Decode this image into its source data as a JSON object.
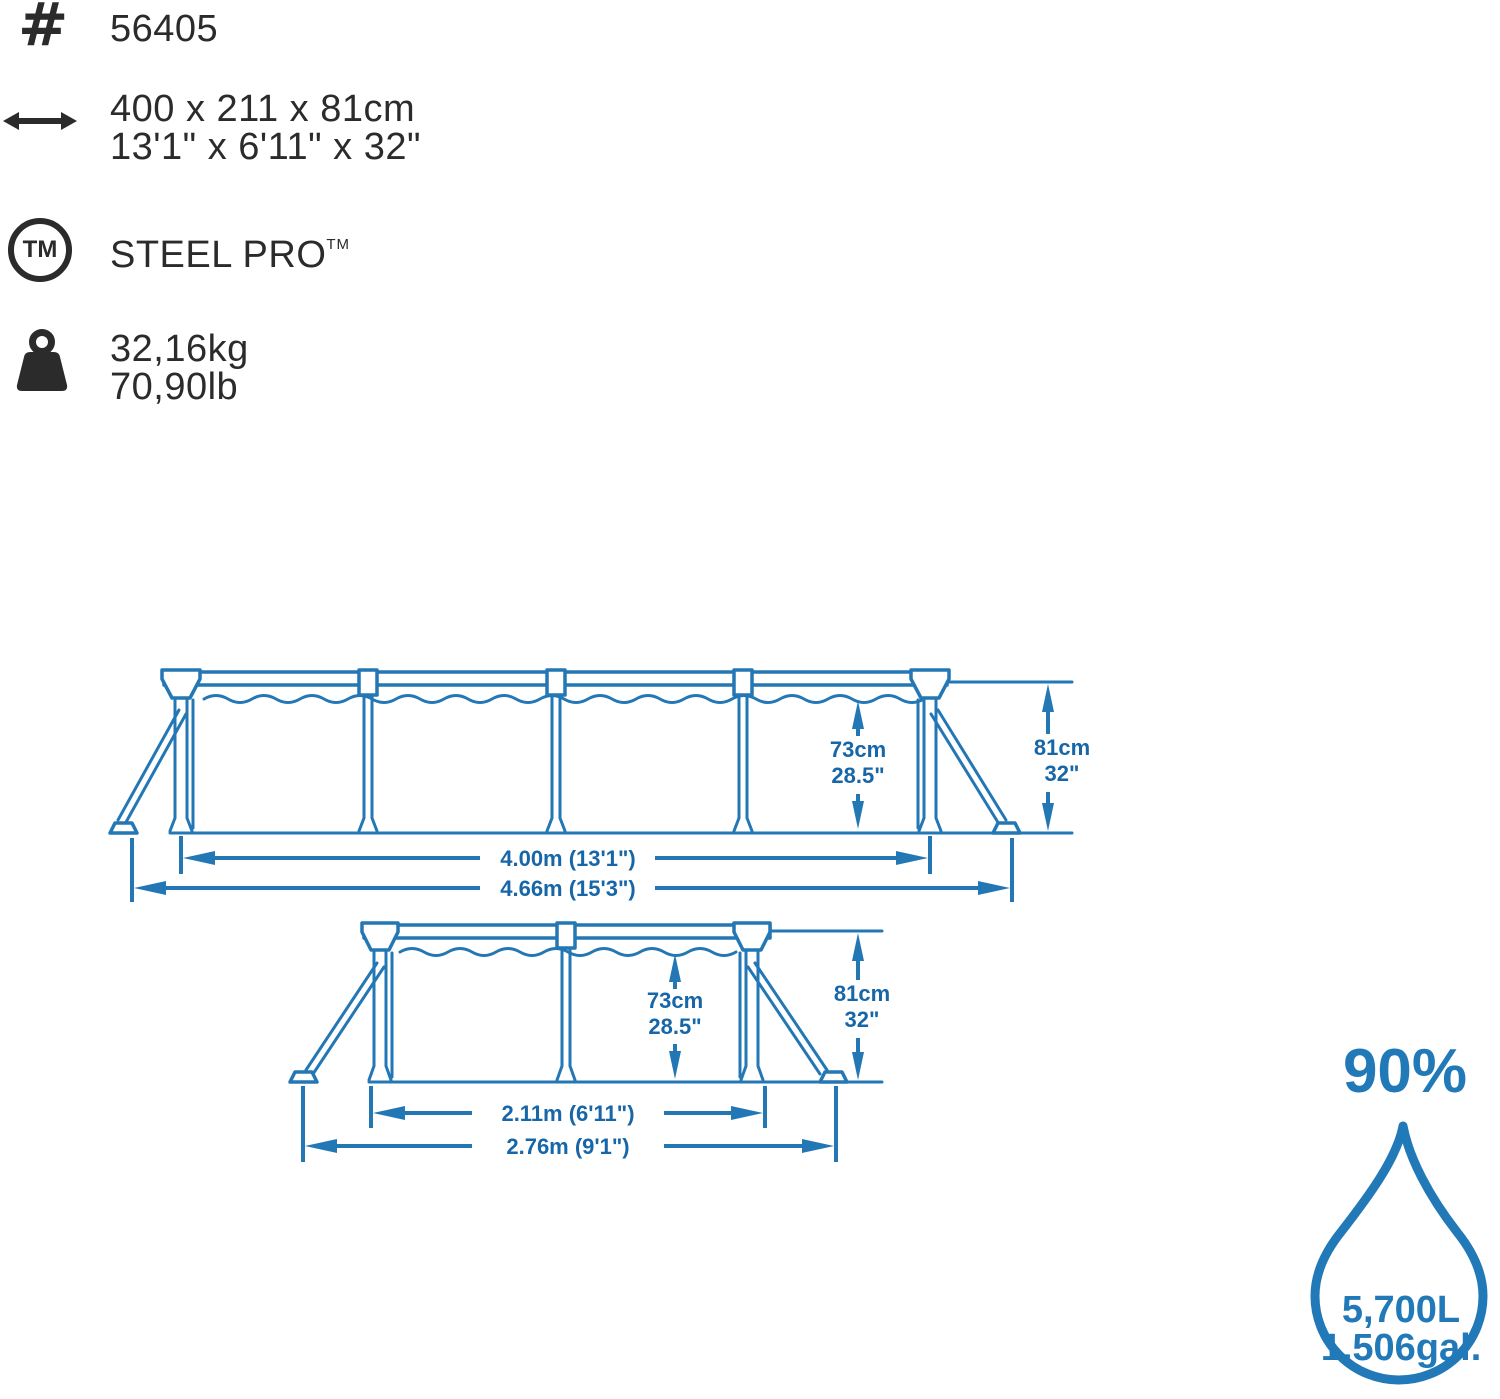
{
  "specs": {
    "hash_glyph": "#",
    "item_number": "56405",
    "size_metric": "400 x 211 x 81cm",
    "size_imperial": "13'1\" x 6'11\" x 32\"",
    "tm_circle_glyph": "TM",
    "brand": "STEEL PRO",
    "trademark": "TM",
    "weight_metric": "32,16kg",
    "weight_imperial": "70,90lb"
  },
  "diagram_long_side": {
    "water_height_cm": "73cm",
    "water_height_in": "28.5\"",
    "frame_height_cm": "81cm",
    "frame_height_in": "32\"",
    "pool_length": "4.00m (13'1\")",
    "footprint_length": "4.66m (15'3\")"
  },
  "diagram_short_side": {
    "water_height_cm": "73cm",
    "water_height_in": "28.5\"",
    "frame_height_cm": "81cm",
    "frame_height_in": "32\"",
    "pool_width": "2.11m (6'11\")",
    "footprint_width": "2.76m (9'1\")"
  },
  "capacity": {
    "fill_level": "90%",
    "volume_liters": "5,700L",
    "volume_gallons": "1,506gal."
  },
  "colors": {
    "ink": "#2b2b2b",
    "diagram_line": "#2377b4",
    "diagram_label": "#1666a8",
    "accent_blue": "#2279b8"
  }
}
